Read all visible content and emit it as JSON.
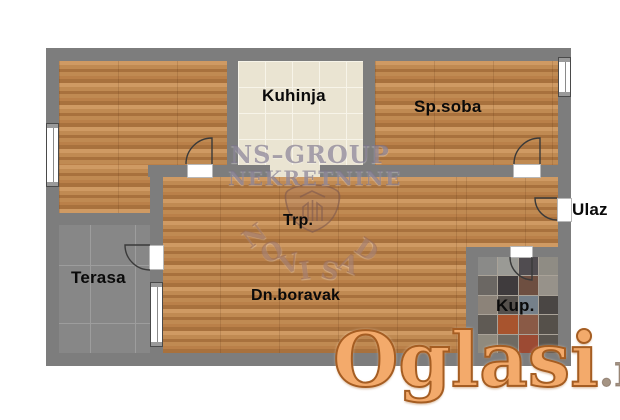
{
  "rooms": {
    "kitchen_label": "Kuhinja",
    "bedroom_label": "Sp.soba",
    "entrance_label": "Ulaz",
    "dining_label": "Trp.",
    "terrace_label": "Terasa",
    "living_label": "Dn.boravak",
    "bathroom_label": "Kup."
  },
  "watermarks": {
    "agency_name": "NS–GROUP",
    "agency_type": "NEKRETNINE",
    "agency_city": "NOVI SAD",
    "city_letters": [
      "N",
      "O",
      "V",
      "I",
      "S",
      "A",
      "D"
    ],
    "portal_name": "Oglasi",
    "portal_tld": ".rs"
  },
  "colors": {
    "wall": "#7d7d7d",
    "wood_1": "#cf9a63",
    "wood_2": "#c08a52",
    "wood_3": "#a8713d",
    "wood_4": "#ba8049",
    "kitchen_tile": "#eae4d2",
    "kitchen_grid": "#f7f4e9",
    "terrace_tile": "#878787",
    "terrace_grid": "#9d9d9d",
    "grout": "#a9a298",
    "label_text": "#0a0a0a",
    "door_line": "#3a3a3a",
    "watermark_lavender": "rgba(120,112,136,0.62)",
    "watermark_sepia": "rgba(146,100,84,0.55)",
    "portal_fill": "#f3aa6b",
    "portal_outline": "#a55d22",
    "portal_tld": "#a59484"
  },
  "bathroom_tiles": [
    [
      "#8a8a88",
      "#9a9a95",
      "#504c50",
      "#8f8c84"
    ],
    [
      "#6b6763",
      "#3f3b3d",
      "#6e4f41",
      "#97928a"
    ],
    [
      "#8c8379",
      "#55504c",
      "#75808a",
      "#4a4644"
    ],
    [
      "#5f5a54",
      "#a8542e",
      "#8a5a46",
      "#55504a"
    ],
    [
      "#8f8a7e",
      "#6f6a62",
      "#9c4a33",
      "#5a554f"
    ]
  ]
}
